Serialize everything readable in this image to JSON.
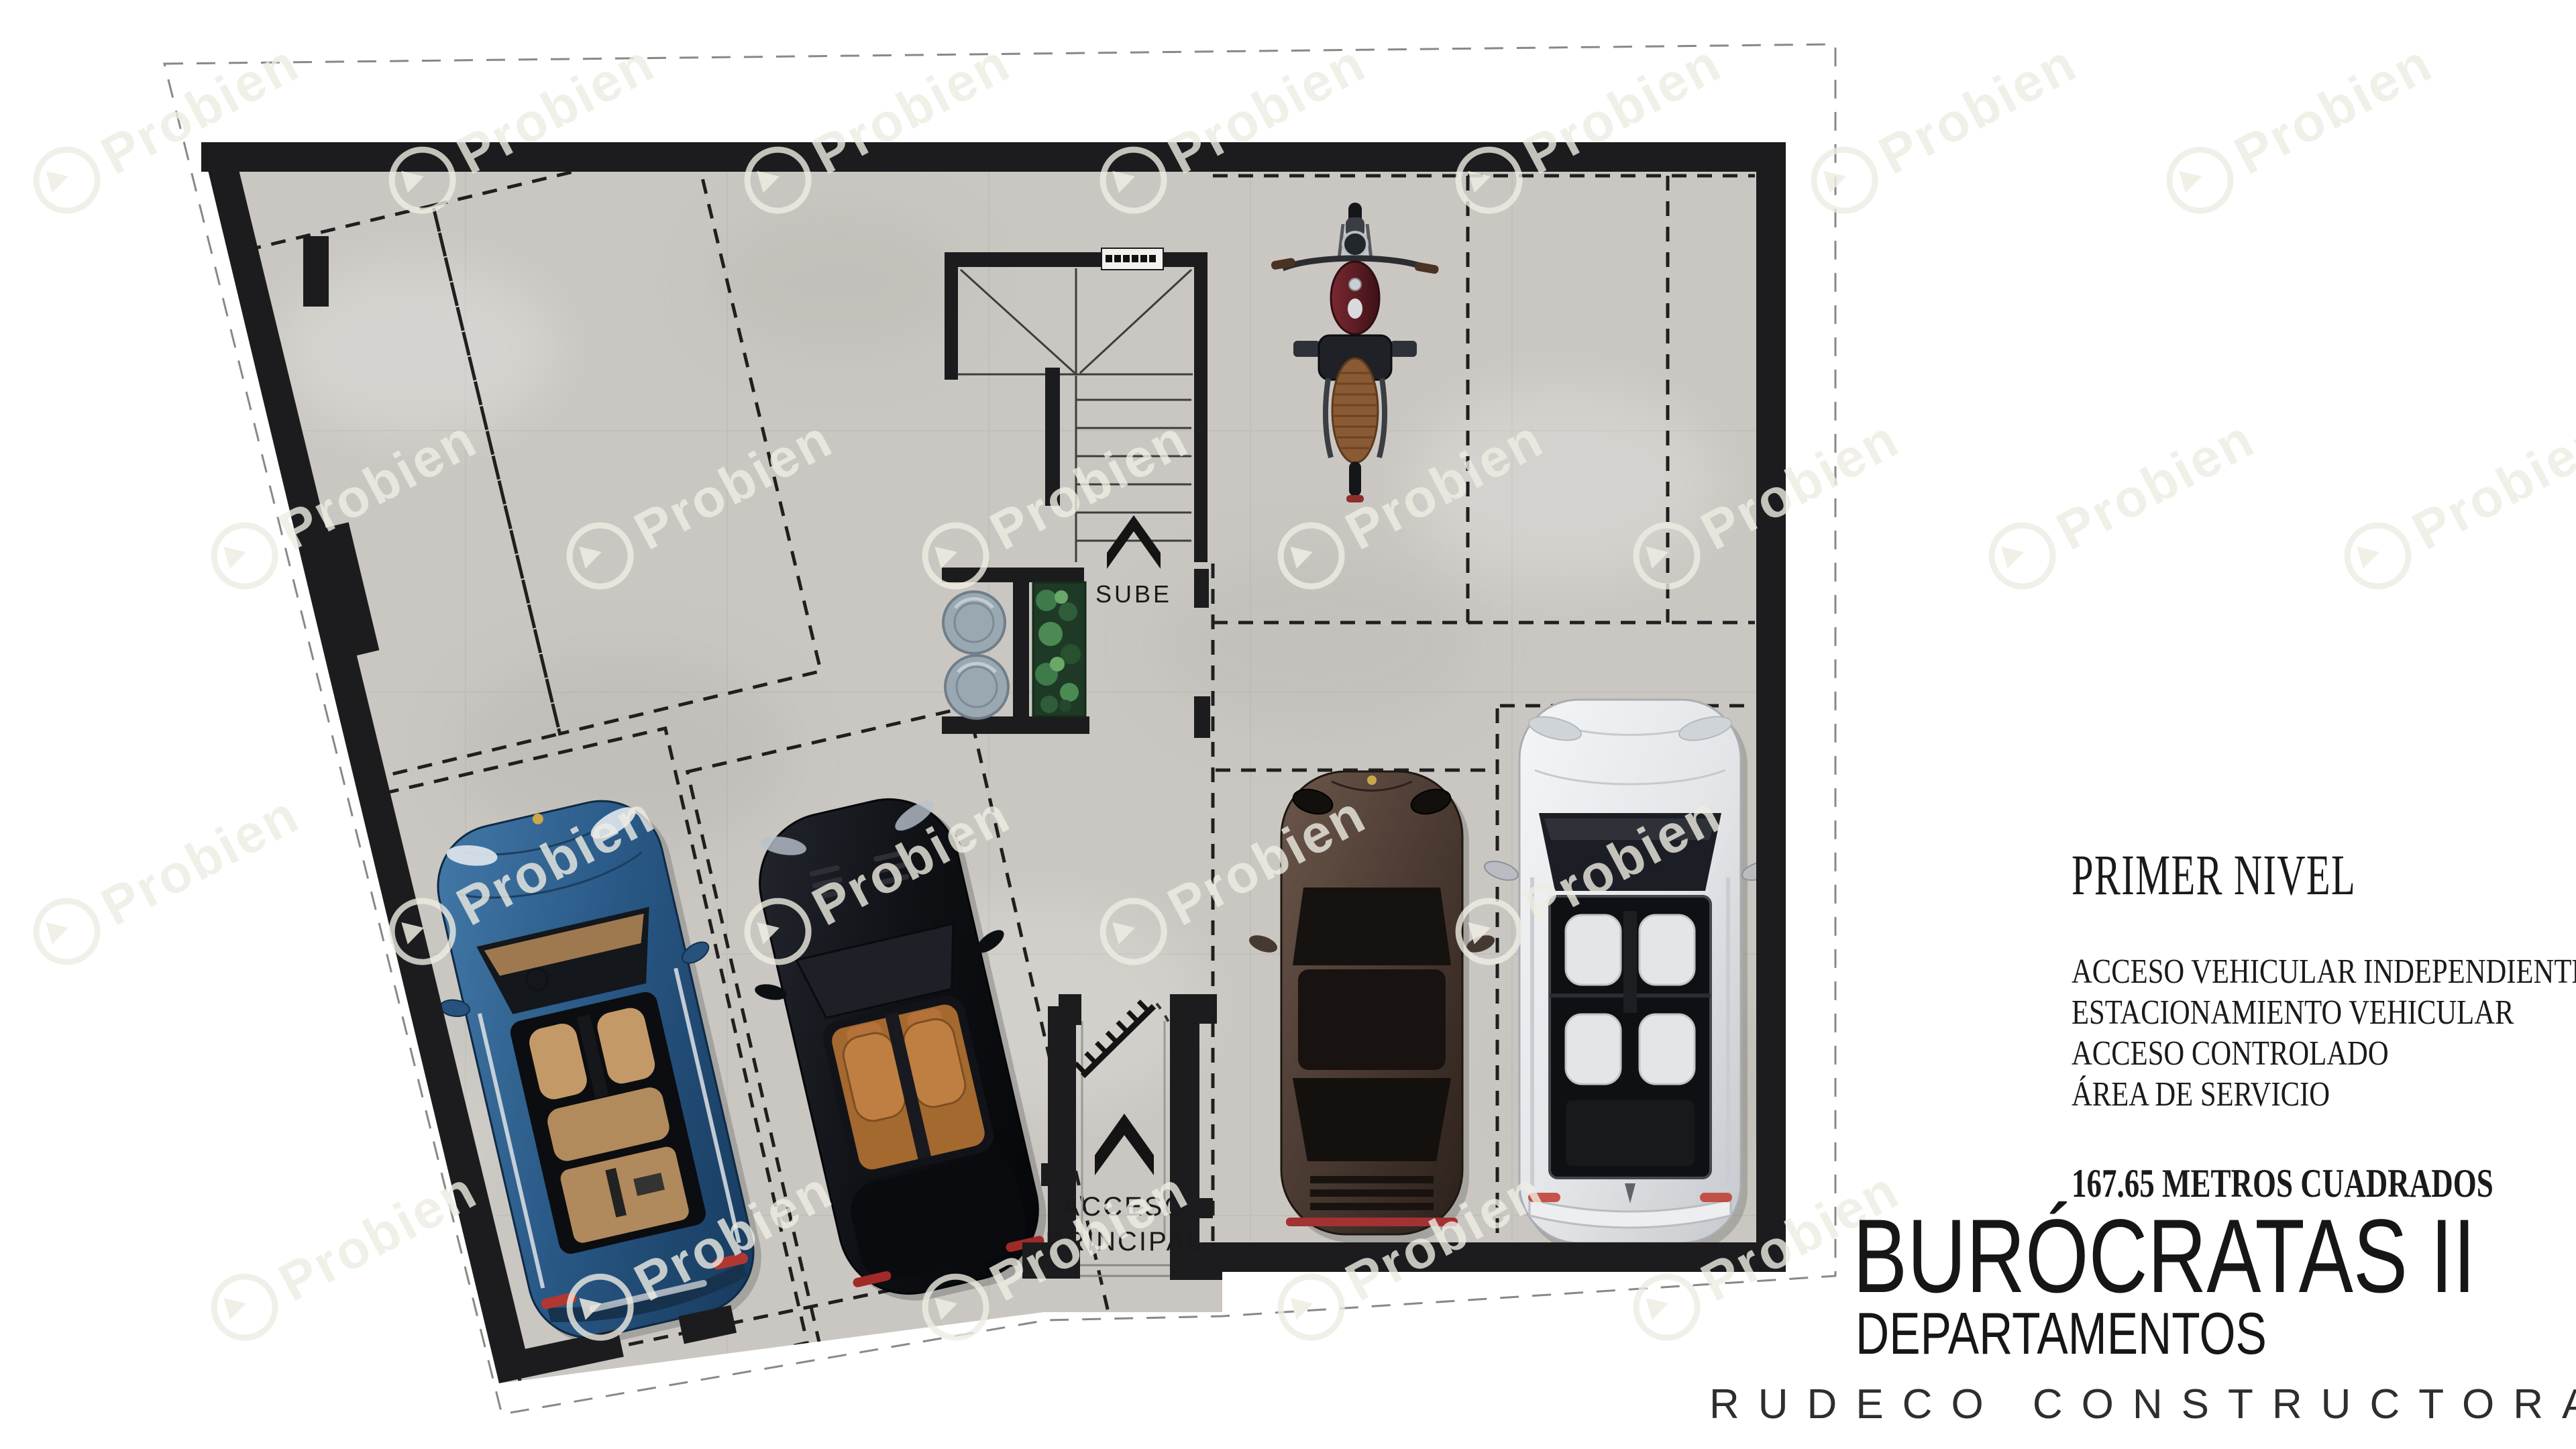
{
  "plan": {
    "labels": {
      "sube": "SUBE",
      "acceso_line1": "ACCESO",
      "acceso_line2": "PRINCIPAL"
    },
    "colors": {
      "wall": "#1c1c1e",
      "floor": "#cac7c2",
      "dashed_line": "#1f1f1f",
      "planter_green": "#2f5d3a",
      "tank_gray": "#9aa8b1"
    },
    "vehicles": [
      {
        "name": "blue-suv",
        "body_color": "#2e5d8a",
        "interior_color": "#c39a67"
      },
      {
        "name": "black-convertible",
        "body_color": "#0e1014",
        "interior_color": "#b5713a"
      },
      {
        "name": "bronze-sports-car",
        "body_color": "#4a3a32",
        "accent_color": "#a33232"
      },
      {
        "name": "silver-suv",
        "body_color": "#e8eaec",
        "roof_color": "#0e1013"
      },
      {
        "name": "motorcycle",
        "tank_color": "#5c1e24",
        "seat_color": "#8a5a33"
      }
    ]
  },
  "info_panel": {
    "title": "PRIMER NIVEL",
    "features": [
      "ACCESO VEHICULAR INDEPENDIENTE",
      "ESTACIONAMIENTO VEHICULAR",
      "ACCESO CONTROLADO",
      "ÁREA DE SERVICIO"
    ],
    "area": "167.65 METROS CUADRADOS"
  },
  "title_block": {
    "project": "BURÓCRATAS II",
    "subtitle": "DEPARTAMENTOS",
    "company": "RUDECO CONSTRUCTORA"
  },
  "watermark": {
    "text": "Probien",
    "icon": "probien-logo-icon"
  }
}
